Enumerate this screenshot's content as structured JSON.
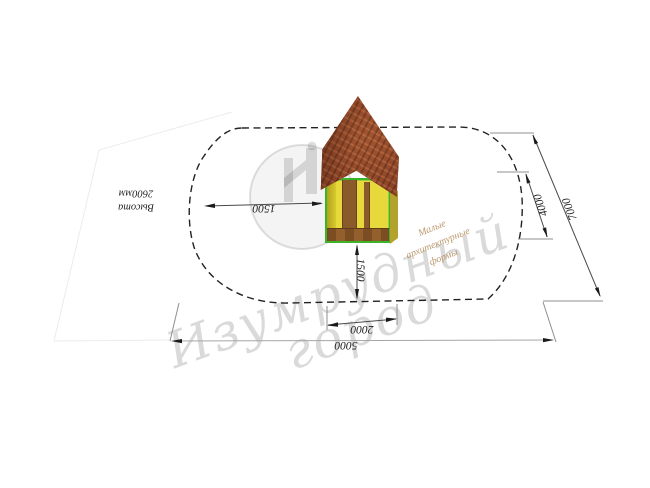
{
  "watermarks": {
    "brand_line1": "Изумрудный",
    "brand_line2": "город",
    "tagline_line1": "Малые",
    "tagline_line2": "архитектурные",
    "tagline_line3": "формы"
  },
  "annotations": {
    "height_line1": "Высота",
    "height_line2": "2600мм"
  },
  "dimensions": {
    "left_offset": "1500",
    "front_offset": "1500",
    "footprint_width": "2000",
    "zone_width": "5000",
    "zone_depth": "4000",
    "plot_depth": "7000"
  },
  "colors": {
    "accent_green": "#3db32a",
    "wall_yellow": "#e7d83b",
    "roof_brown": "#8f4527",
    "dash_line": "#222222",
    "watermark_gray": "#d0d0d0",
    "tagline_tan": "#b28855"
  }
}
